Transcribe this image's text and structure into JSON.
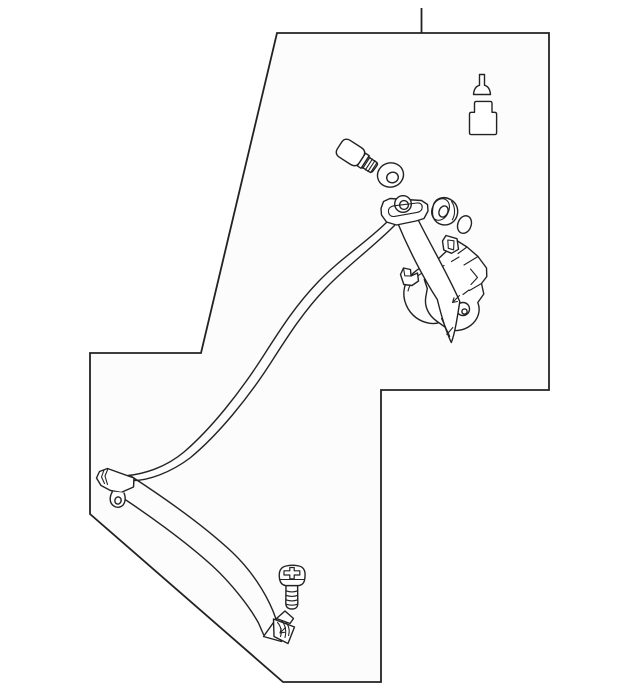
{
  "canvas": {
    "width": 640,
    "height": 693,
    "background": "#ffffff"
  },
  "style": {
    "line_color": "#222222",
    "panel_fill": "#fcfcfc",
    "part_fill": "#ffffff"
  },
  "diagram": {
    "description": "Exploded parts line drawing of a seat belt retractor assembly inside an irregular panel outline with a leader line at top",
    "leader_line_d": "M421.5,8 L421.5,33",
    "panel_outline_d": "M277,33 L549,33 L549,390 L381,390 L381,682 L283,682 L90,514 L90,353 L201,353 Z",
    "parts": {
      "shoulder_belt": {
        "label": "shoulder belt webbing run",
        "upper_edge_d": "M387,222 C363,245 340,259 318,282 C295,306 280,330 262,358 C240,392 212,428 184,452 C165,468 143,474 128,475.5",
        "lower_edge_d": "M394.5,225.5 C371,249 348,265 326,288 C303,312 288,336 270,364 C248,398 219,434 190,458 C170,473 148,480.5 133.5,480.5"
      },
      "lap_belt": {
        "label": "lap belt webbing run",
        "upper_edge_d": "M131.5,476.5 C163,497 203,525 232,552 C252,571 265.5,593 273,611 L276,619",
        "lower_edge_d": "M114.5,492.5 C146,513 185,541 212.5,566 C231,583 249.5,606.5 258.5,623 L263.5,634.5"
      },
      "left_anchor": {
        "label": "lower left belt anchor",
        "plate_d": "M134,478 L107.5,468.5 L99.5,471.5 L96.5,478 L101,485.5 L110.5,490.5 L121,492.5 L133.5,487 Z",
        "bevel_lines_d": "M104,470 L101.5,477 L104.5,483.5 M108,468.7 L105,476 L107.5,484.5 M134,478 L133.5,487",
        "tab_d": "M112.5,491.5 C109.5,496.5 109,502.5 113.5,505.8 C118,509 123.5,506.8 124.8,501.5 C125.6,498 124.8,494.6 123.8,492.6",
        "tab_hole_d": "M115,499.7 A3.1,3.6 15 1 0 121,501.3 A3.1,3.6 15 1 0 115,499.7 Z"
      },
      "bottom_anchor": {
        "label": "bottom belt anchor plate",
        "tip_d": "M263.5,636.5 L276,619 L281.5,641.5 Z",
        "fold_d": "M276.5,618.5 L285,611 L293.5,618.5 L290,623.5 Z",
        "plate_d": "M273.5,619 L294.5,627 L288,643.5 L274,636.5 Z",
        "wrap_lines_d": "M277.5,622.5 C281,626 282,632 280.5,636.5 M281.5,620.5 C285.5,625 286.5,631 285,637.5 M286,622.5 C289,626 290,631 288.5,635.5",
        "arrow_d": "M285.5,627.5 L280,633 M280,633 L281.2,628.6 M280,633 L284.5,632.3"
      },
      "anchor_screw": {
        "label": "phillips head screw",
        "head_d": "M279.5,578.5 C278.3,570.5 281.5,567 286,566 C290,565 295,565 299,566 C303.5,567 306,570.5 304.8,578.5 C304.5,582 303,584.8 299,585.6 L285.5,585.6 C281.3,584.8 280,582 279.5,578.5 Z",
        "rim_d": "M280.2,579.5 L304.3,579.5",
        "cross_d": "M289.8,567.5 L294.2,567.5 L294.2,570.8 L299.8,570.8 L299.8,575 L294.2,575 L294.2,578.8 L289.8,578.8 L289.8,575 L284,575 L284,570.8 L289.8,570.8 Z",
        "shank_d": "M286,585.6 L285.8,603 C285.8,607.2 288,609 292,609 C296,609 297.8,607.2 297.8,603 L297.6,585.6 Z",
        "thread_lines_d": "M285.9,590.8 Q292,593 297.7,590.8 M285.9,595.3 Q292,597.5 297.7,595.3 M285.9,599.8 Q292,602 297.7,599.8 M286,604.2 Q292,606.2 297.6,604.2"
      },
      "shoulder_bolt": {
        "label": "shoulder bolt",
        "head_d": "M6.5,0 L19.5,0 Q26,0 26,6.5 L26,13.5 Q26,20 19.5,20 L6.5,20 Q0,20 0,13.5 L0,6.5 Q0,0 6.5,0 Z",
        "collar_d": "M26,2.5 L30.5,2.5 L30.5,17.5 L26,17.5 Z",
        "shank_d": "M30.5,4 L40,4 Q42.5,4.2 42.3,7 L42,13.5 Q41.8,16 39,16 L30.5,16 Z",
        "thread_lines_d": "M32,3.3 L32,16.7 M35,3.4 L35,16.6 M38,3.5 L38,16.5 M40.8,3.9 L40.8,16.1"
      },
      "grommet": {
        "label": "spacer grommet washer",
        "outer_d": "M377.9,178.4 A13,12 -15 1 0 403.1,171.6 A13,12 -15 1 0 377.9,178.4 Z",
        "inner_d": "M386.9,179 A5.8,5.1 -15 1 0 398.1,176 A5.8,5.1 -15 1 0 386.9,179 Z"
      },
      "push_pin": {
        "label": "push pin fastener",
        "outline_d": "M473.5,94.5 Q474.2,86.5 479.5,85.3 L479.5,74.5 L484.5,74.5 L484.5,85.3 Q489.8,86.5 490.5,94.5 Z"
      },
      "cap": {
        "label": "anchor trim cap",
        "outline_d": "M474.5,112.3 L474.5,103.3 Q474.5,101.4 476.5,101.4 L490,101.4 Q492,101.4 492,103.3 L492,112.3 L494.6,112.3 Q496.6,112.3 496.6,114.3 L496.6,132.6 Q496.6,134.6 494.6,134.6 L471.5,134.6 Q469.5,134.6 469.5,132.6 L469.5,114.3 Q469.5,112.3 471.5,112.3 Z"
      },
      "bushing": {
        "label": "guide bushing cylinder",
        "body_d": "M434.5,202.5 C438,197.2 445,196.3 450.5,199.5 C453.6,201.2 456,203.8 457,207 C458.8,212.5 457,218.8 452.5,222.3 C447.8,225.9 441.3,225.8 436.8,222.2 C433.7,219.6 432.2,215.4 432.4,211.3 C432.6,208 433.2,204.7 434.5,202.5 Z",
        "face_d": "M433.1,206 A8.2,10.6 25 1 0 447.9,213 A8.2,10.6 25 1 0 433.1,206 Z",
        "hole_d": "M439.6,209.7 A4.3,5.5 25 1 0 447.4,213.3 A4.3,5.5 25 1 0 439.6,209.7 Z",
        "rim_d": "M451.5,201.5 C455,206 455.8,214 452.3,219.8"
      },
      "o_ring": {
        "label": "o-ring",
        "outline_d": "M458.3,222.3 A6.6,8.7 20 1 0 470.7,226.8 A6.6,8.7 20 1 0 458.3,222.3 Z"
      },
      "upper_anchor": {
        "label": "upper anchor bracket with belt guide boss",
        "plate_d": "M381,208.5 L383.5,201.5 L390,198.5 L421.5,200.5 L427.5,204.5 L428,211 L424,218.5 L416,221 L396.5,225 L386.5,222 L381.5,215 Z",
        "boss_d": "M394.7,204 A8.3,8.3 0 1 0 411.3,204 A8.3,8.3 0 1 0 394.7,204 Z",
        "boss_hole_d": "M399.6,205 A4.4,4.4 0 1 0 408.4,205 A4.4,4.4 0 1 0 399.6,205 Z",
        "slot_d": "M388.5,212 C388,208.5 390.5,206.3 394,205.8 L417,203 C420.5,202.7 422.4,204.6 422.2,207.4 C422,210.2 420,211.9 417,212.4 L394.5,216.4 C391.2,216.9 389,215 388.5,212 Z"
      },
      "retractor": {
        "label": "seat belt retractor mechanism",
        "drum_d": "M429.5,264 C417.5,267.5 407,276.5 404.5,287.5 C401.8,299.5 407.5,311.5 416.5,318 C424.5,323.5 434,325 440.5,322",
        "drum_inner_d": "M427,270.5 C417.5,274.5 410,282 408,291",
        "foot_d": "M400.5,274.5 L403.5,268 L410.5,269.5 L411,276 L417.5,273 L418.5,281 L412,285.5 L403.8,284.5 Z",
        "foot_fold_d": "M403.5,268 L404.8,275.8 L411,276",
        "frame_d": "M437,260 L457.5,241 L467,247 L478,256.5 L486.5,268 L486.8,276.5 L481.5,283.5 L483.8,294 L477.8,302.5 C481,310.5 478.3,319.5 470.8,325.3 C463,331.3 452.5,332.3 446,327.8 L436.5,321 C428,314.8 424.3,306 425.8,297 L427.3,288.5 L424.3,279.5 L429.5,268.5 Z",
        "facet_lines_d": "M437,260 L430,265.5 M432.5,272.5 L444,265.5 M459,257 L451.5,261.5 M467,247 L458,253.5 M478,256.5 L464,265 M481.5,283.5 L469.5,290.5 M470.5,269 L477.5,277.5 L471,284.5 M463,294.5 L469,290",
        "spool_d": "M456.5,309 A6.5,6.5 0 1 0 469.5,309 A6.5,6.5 0 1 0 456.5,309 Z",
        "spool_hub_d": "M461.9,311.5 A2.6,2.6 0 1 0 467.1,311.5 A2.6,2.6 0 1 0 461.9,311.5 Z",
        "strap_d": "M397.5,222.5 C408,248 423,277.5 437.3,299.5 C441.5,316.5 446,331.5 451.3,342.5 C454.8,334 457.3,317.5 459.8,301.5 C447.5,273.5 429,242 417.5,218.5 Z",
        "strap_fold_lines_d": "M441.5,318.5 L449.8,336.5 M446.8,334.5 L452.8,327.5",
        "arrow_d": "M459.5,295.5 L452.5,302.5 M452.5,302.5 L454,297.8 M452.5,302.5 L457.5,301.5",
        "tab_d": "M446,235.5 L442.5,241 L443.8,250 L451.5,253.3 L458.5,249.3 L457,238.7 Z",
        "tab_slot_d": "M447.8,240 L448.3,248.3 L453.6,249.8 L454,240.8 Z"
      }
    }
  }
}
